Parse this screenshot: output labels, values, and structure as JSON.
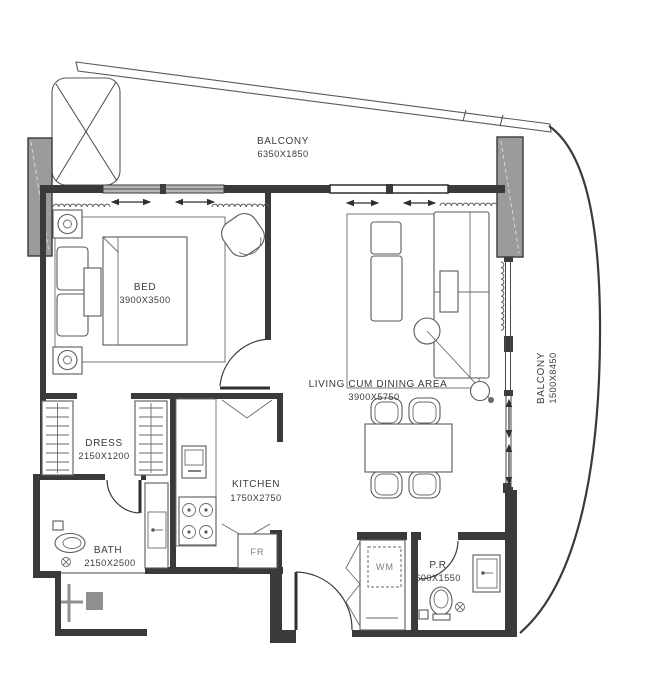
{
  "plan_title": "apartment-floor-plan",
  "rooms": {
    "balcony_top": {
      "label": "BALCONY",
      "dims": "6350X1850"
    },
    "balcony_right": {
      "label": "BALCONY",
      "dims": "1500X8450"
    },
    "bed": {
      "label": "BED",
      "dims": "3900X3500"
    },
    "living": {
      "label": "LIVING CUM DINING AREA",
      "dims": "3900X5750"
    },
    "dress": {
      "label": "DRESS",
      "dims": "2150X1200"
    },
    "kitchen": {
      "label": "KITCHEN",
      "dims": "1750X2750"
    },
    "bath": {
      "label": "BATH",
      "dims": "2150X2500"
    },
    "powder_room": {
      "label": "P.R",
      "dims": "600X1550"
    }
  },
  "appliances": {
    "fridge": "FR",
    "washing_machine": "WM"
  },
  "colors": {
    "wall_line": "#3a3a3a",
    "structure_fill": "#9b9b9b",
    "glass_fill": "#b5b5b5",
    "fixture_gray": "#8f8f8f",
    "background": "#ffffff",
    "text": "#3b3b3b"
  }
}
